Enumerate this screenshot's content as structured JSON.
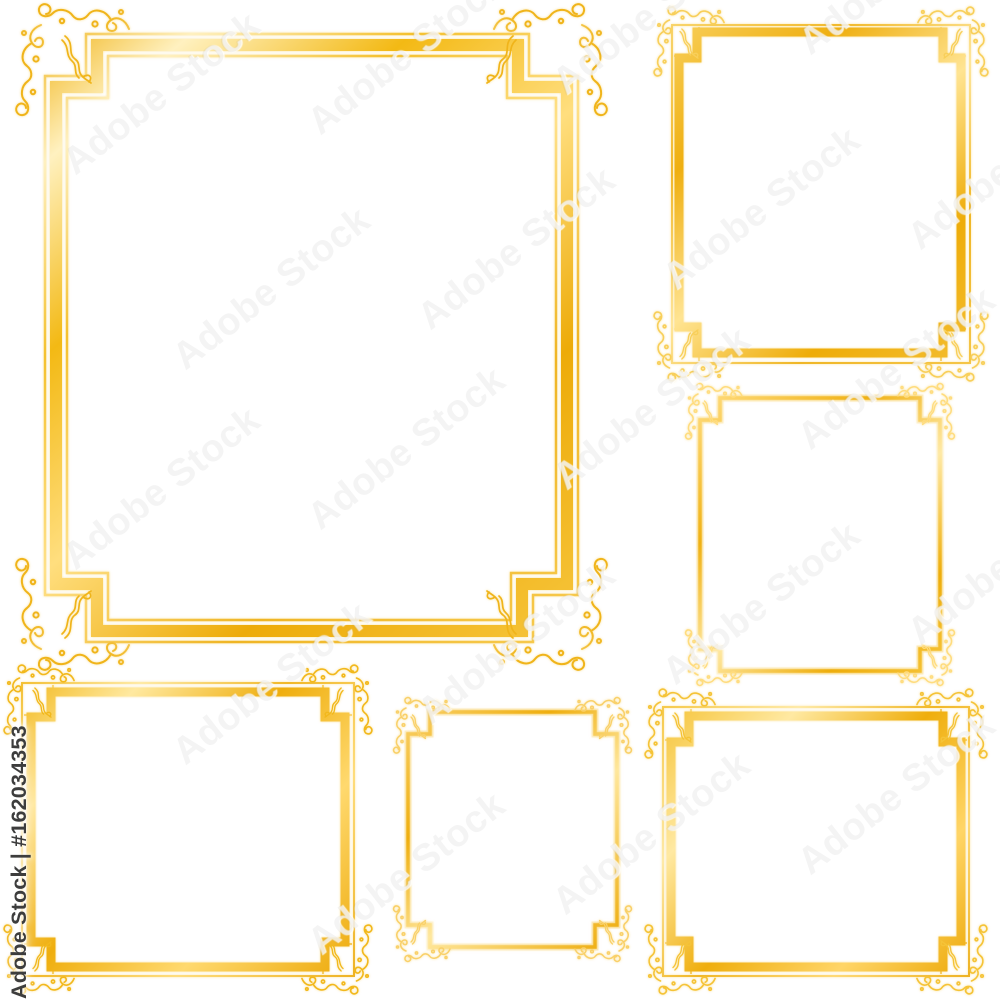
{
  "artwork": {
    "description": "Set of six decorative golden vector frames on a white background",
    "frames": [
      {
        "name": "large-portrait-frame",
        "position": "top-left",
        "style": "thin-thick-thin gold border with stepped corners, notch brackets and scroll flourishes"
      },
      {
        "name": "portrait-frame",
        "position": "top-right",
        "style": "thin outer line with thick inner band, stepped corner tabs, small corner flourishes"
      },
      {
        "name": "square-frame",
        "position": "middle-right",
        "style": "single gold line with stepped corners and small corner flourishes"
      },
      {
        "name": "small-square-frame",
        "position": "bottom-center",
        "style": "single gold line with stepped corners and small corner flourishes"
      },
      {
        "name": "landscape-frame",
        "position": "bottom-left",
        "style": "thick outer band with thin inner line, stepped corner tabs, small corner flourishes"
      },
      {
        "name": "wide-landscape-frame",
        "position": "bottom-right",
        "style": "thick outer band with thin inner line, stepped corner tabs, small corner flourishes"
      }
    ]
  },
  "watermark": {
    "tile_text": "Adobe Stock",
    "id_text": "Adobe Stock | #162034353"
  },
  "palette": {
    "gold_deep": "#EDA90B",
    "gold_mid": "#F7C52F",
    "gold_pale": "#FFEFBE",
    "id_text_color": "#3D3D3D",
    "background": "#FFFFFF"
  }
}
